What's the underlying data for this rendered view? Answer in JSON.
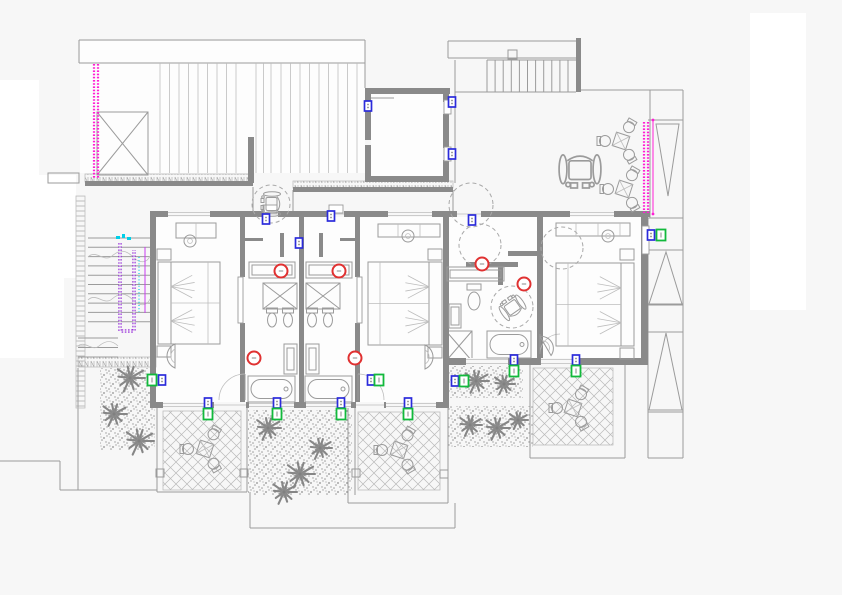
{
  "meta": {
    "type": "architectural-floor-plan-cad-drawing",
    "visible_text": "none"
  },
  "colors": {
    "background": "#f7f7f7",
    "paper_white": "#ffffff",
    "wall": "#8a8a8a",
    "line": "#9b9b9b",
    "light_line": "#bdbdbd",
    "magenta": "#ff1fd4",
    "purple": "#8b16d6",
    "cyan": "#00cfe8",
    "red_marker": "#e03131",
    "blue_marker": "#2b2bdb",
    "green_marker": "#12b93c"
  },
  "white_patches": [
    [
      0,
      80,
      39,
      278
    ],
    [
      0,
      175,
      76,
      103
    ],
    [
      0,
      278,
      64,
      80
    ],
    [
      750,
      13,
      56,
      297
    ]
  ],
  "room_fills": [
    [
      80,
      41,
      285,
      132
    ],
    [
      371,
      94,
      72,
      82
    ],
    [
      156,
      217,
      287,
      185
    ],
    [
      449,
      217,
      192,
      141
    ]
  ],
  "walls": [
    [
      150,
      211,
      500,
      6
    ],
    [
      150,
      211,
      6,
      197
    ],
    [
      150,
      402,
      298,
      6
    ],
    [
      443,
      358,
      205,
      7
    ],
    [
      641,
      211,
      7,
      154
    ],
    [
      443,
      211,
      6,
      154
    ],
    [
      443,
      358,
      6,
      50
    ],
    [
      537,
      217,
      6,
      148
    ],
    [
      240,
      217,
      5,
      60
    ],
    [
      240,
      323,
      5,
      84
    ],
    [
      355,
      217,
      5,
      60
    ],
    [
      355,
      323,
      5,
      84
    ],
    [
      299,
      217,
      5,
      186
    ],
    [
      280,
      233,
      4,
      24
    ],
    [
      319,
      233,
      4,
      24
    ],
    [
      245,
      238,
      18,
      3
    ],
    [
      340,
      238,
      18,
      3
    ],
    [
      466,
      262,
      52,
      5
    ],
    [
      498,
      267,
      5,
      18
    ],
    [
      508,
      251,
      29,
      5
    ],
    [
      365,
      88,
      85,
      6
    ],
    [
      365,
      88,
      6,
      52
    ],
    [
      365,
      145,
      6,
      37
    ],
    [
      443,
      88,
      6,
      14
    ],
    [
      443,
      114,
      6,
      34
    ],
    [
      443,
      160,
      6,
      22
    ],
    [
      365,
      176,
      84,
      6
    ],
    [
      85,
      181,
      168,
      5
    ],
    [
      293,
      187,
      160,
      5
    ],
    [
      248,
      137,
      6,
      46
    ],
    [
      576,
      38,
      5,
      54
    ]
  ],
  "windows": [
    [
      168,
      211,
      42,
      6
    ],
    [
      388,
      211,
      44,
      6
    ],
    [
      570,
      211,
      44,
      6
    ],
    [
      163,
      402,
      46,
      6
    ],
    [
      249,
      402,
      45,
      6
    ],
    [
      306,
      402,
      45,
      6
    ],
    [
      386,
      402,
      50,
      6
    ],
    [
      466,
      358,
      42,
      7
    ],
    [
      541,
      358,
      36,
      7
    ]
  ],
  "door_gaps": [
    [
      214,
      402,
      32,
      6
    ],
    [
      356,
      402,
      28,
      6
    ],
    [
      457,
      211,
      24,
      6
    ],
    [
      263,
      211,
      15,
      6
    ],
    [
      329,
      211,
      15,
      6
    ]
  ],
  "door_leafs": [
    [
      263,
      205,
      14,
      8
    ],
    [
      329,
      205,
      14,
      8
    ],
    [
      238,
      277,
      5,
      46
    ],
    [
      357,
      277,
      5,
      46
    ],
    [
      444,
      100,
      7,
      14
    ],
    [
      444,
      147,
      7,
      14
    ],
    [
      642,
      226,
      7,
      28
    ]
  ],
  "thin_lines": [
    [
      79,
      40,
      365,
      40
    ],
    [
      79,
      40,
      79,
      63
    ],
    [
      79,
      63,
      365,
      63
    ],
    [
      365,
      40,
      365,
      88
    ],
    [
      369,
      98,
      394,
      98
    ],
    [
      448,
      41,
      576,
      41
    ],
    [
      448,
      41,
      448,
      58
    ],
    [
      448,
      58,
      576,
      58
    ],
    [
      487,
      60,
      576,
      60
    ],
    [
      455,
      92,
      576,
      92
    ],
    [
      455,
      60,
      455,
      92
    ],
    [
      455,
      92,
      455,
      183
    ],
    [
      650,
      90,
      650,
      218
    ],
    [
      580,
      90,
      683,
      90
    ],
    [
      683,
      90,
      683,
      458
    ],
    [
      648,
      218,
      648,
      458
    ],
    [
      648,
      120,
      683,
      120
    ],
    [
      648,
      218,
      683,
      218
    ],
    [
      648,
      250,
      683,
      250
    ],
    [
      648,
      305,
      683,
      305
    ],
    [
      648,
      332,
      683,
      332
    ],
    [
      648,
      412,
      683,
      412
    ],
    [
      648,
      458,
      683,
      458
    ],
    [
      253,
      187,
      253,
      211
    ],
    [
      293,
      190,
      293,
      211
    ],
    [
      453,
      190,
      453,
      211
    ],
    [
      0,
      461,
      60,
      461
    ],
    [
      60,
      461,
      60,
      490
    ],
    [
      60,
      490,
      157,
      490
    ],
    [
      78,
      368,
      78,
      490
    ],
    [
      157,
      408,
      157,
      492
    ],
    [
      247,
      408,
      247,
      492
    ],
    [
      157,
      492,
      247,
      492
    ],
    [
      250,
      492,
      250,
      528
    ],
    [
      250,
      528,
      455,
      528
    ],
    [
      455,
      503,
      455,
      528
    ],
    [
      348,
      408,
      348,
      503
    ],
    [
      448,
      408,
      448,
      503
    ],
    [
      348,
      503,
      448,
      503
    ],
    [
      355,
      408,
      355,
      495
    ],
    [
      530,
      365,
      530,
      458
    ],
    [
      625,
      365,
      625,
      458
    ],
    [
      530,
      458,
      625,
      458
    ]
  ],
  "thin_rects": [
    [
      48,
      173,
      31,
      10
    ],
    [
      508,
      50,
      9,
      9
    ],
    [
      249,
      262,
      46,
      16
    ],
    [
      252,
      265,
      40,
      10
    ],
    [
      306,
      262,
      46,
      16
    ],
    [
      309,
      265,
      40,
      10
    ],
    [
      447,
      267,
      57,
      14
    ],
    [
      450,
      270,
      51,
      8
    ],
    [
      284,
      344,
      13,
      30
    ],
    [
      287,
      348,
      7,
      22
    ],
    [
      306,
      344,
      13,
      30
    ],
    [
      309,
      348,
      7,
      22
    ],
    [
      449,
      304,
      12,
      24
    ],
    [
      451,
      307,
      8,
      18
    ],
    [
      156,
      469,
      8,
      8
    ],
    [
      240,
      469,
      8,
      8
    ],
    [
      352,
      469,
      8,
      8
    ],
    [
      440,
      470,
      8,
      8
    ]
  ],
  "x_boxes": [
    [
      97,
      112,
      51,
      63
    ],
    [
      263,
      283,
      34,
      26
    ],
    [
      306,
      283,
      34,
      26
    ],
    [
      446,
      331,
      26,
      30
    ]
  ],
  "hatch_bands": [
    [
      85,
      174,
      168,
      8
    ],
    [
      293,
      181,
      160,
      7
    ],
    [
      78,
      357,
      78,
      10
    ]
  ],
  "ladder_strip": [
    76,
    196,
    9,
    212
  ],
  "rafter_groups": [
    {
      "x1": 160,
      "x2": 243,
      "step": 9.5,
      "y1": 63,
      "y2": 173
    },
    {
      "x1": 256,
      "x2": 278,
      "step": 7.5,
      "y1": 63,
      "y2": 173
    },
    {
      "x1": 281,
      "x2": 357,
      "step": 9.5,
      "y1": 63,
      "y2": 173
    }
  ],
  "top_stair_treads": {
    "x1": 487,
    "x2": 576,
    "step": 8.1,
    "y1": 60,
    "y2": 92
  },
  "left_stair": {
    "treads": {
      "y1": 238,
      "y2": 331,
      "step": 9.3,
      "x1": 88,
      "x2": 150
    },
    "treads2": {
      "y1": 338,
      "y2": 357,
      "step": 9.5,
      "x1": 78,
      "x2": 118
    },
    "waves": [
      "M88,257 C96,249 104,263 112,256 S126,250 133,257 S147,263 150,256",
      "M88,300 C96,292 104,306 112,299 S126,293 133,300 S147,306 150,299",
      "M78,346 C85,340 92,352 99,346 S112,340 118,346"
    ],
    "rail_path": "M120,243 L120,331 L134,331 L134,250",
    "rail_thin": [
      145,
      247,
      145,
      313
    ],
    "cyan_dotted": [
      139,
      257,
      139,
      312
    ],
    "top_marks": [
      [
        116,
        236,
        4,
        3
      ],
      [
        122,
        234,
        3,
        4
      ],
      [
        127,
        237,
        4,
        3
      ]
    ]
  },
  "diamond_terraces": [
    [
      163,
      411,
      78,
      79
    ],
    [
      358,
      412,
      82,
      78
    ],
    [
      533,
      368,
      80,
      77
    ]
  ],
  "stipple_beds": [
    [
      100,
      368,
      55,
      82
    ],
    [
      248,
      410,
      104,
      85
    ],
    [
      448,
      366,
      75,
      32
    ],
    [
      448,
      406,
      85,
      41
    ]
  ],
  "palms": [
    [
      130,
      378,
      15
    ],
    [
      114,
      414,
      13
    ],
    [
      139,
      441,
      15
    ],
    [
      268,
      428,
      13
    ],
    [
      300,
      474,
      15
    ],
    [
      320,
      448,
      12
    ],
    [
      284,
      492,
      13
    ],
    [
      476,
      381,
      13
    ],
    [
      504,
      384,
      11
    ],
    [
      470,
      425,
      12
    ],
    [
      497,
      428,
      13
    ],
    [
      518,
      420,
      10
    ]
  ],
  "tables": [
    [
      205,
      449,
      17
    ],
    [
      399,
      450,
      17
    ],
    [
      573,
      408,
      16
    ],
    [
      621,
      141,
      16
    ],
    [
      624,
      189,
      16
    ]
  ],
  "beds": [
    {
      "x": 158,
      "y": 262,
      "w": 62,
      "h": 82,
      "head": "left"
    },
    {
      "x": 368,
      "y": 262,
      "w": 74,
      "h": 83,
      "head": "right"
    },
    {
      "x": 556,
      "y": 263,
      "w": 78,
      "h": 83,
      "head": "right"
    }
  ],
  "nightstands": [
    [
      157,
      249,
      14,
      11
    ],
    [
      157,
      346,
      14,
      11
    ],
    [
      428,
      249,
      14,
      11
    ],
    [
      428,
      347,
      14,
      11
    ],
    [
      620,
      249,
      14,
      11
    ],
    [
      620,
      348,
      14,
      11
    ]
  ],
  "desks": [
    {
      "x": 176,
      "y": 223,
      "w": 40,
      "h": 15,
      "chair": [
        190,
        241
      ]
    },
    {
      "x": 378,
      "y": 224,
      "w": 62,
      "h": 13,
      "chair": [
        408,
        236
      ]
    },
    {
      "x": 556,
      "y": 223,
      "w": 74,
      "h": 13,
      "chair": [
        608,
        236
      ]
    }
  ],
  "armchairs": [
    {
      "cx": 171,
      "cy": 356,
      "r": 13,
      "rot": 0
    },
    {
      "cx": 429,
      "cy": 357,
      "r": 13,
      "rot": 180
    },
    {
      "cx": 549,
      "cy": 344,
      "r": 12,
      "rot": 150
    }
  ],
  "door_arcs": [
    {
      "d": "M219,400 A26,26 0 0 1 245,374",
      "leaf": [
        245,
        400,
        245,
        374
      ]
    },
    {
      "d": "M384,400 A26,26 0 0 0 358,374",
      "leaf": [
        358,
        400,
        358,
        374
      ]
    },
    {
      "d": "M540,354 A20,20 0 0 1 560,334",
      "leaf": [
        540,
        334,
        540,
        354
      ]
    }
  ],
  "bathtubs": [
    [
      248,
      376,
      47,
      26
    ],
    [
      305,
      376,
      47,
      26
    ],
    [
      487,
      331,
      44,
      27
    ]
  ],
  "toilets_small": [
    [
      272,
      316
    ],
    [
      288,
      316
    ],
    [
      312,
      316
    ],
    [
      328,
      316
    ]
  ],
  "toilet_large": {
    "tank": [
      467,
      284,
      14,
      6
    ],
    "bowl": [
      474,
      301,
      6,
      9
    ]
  },
  "red_lights": [
    [
      281,
      271
    ],
    [
      339,
      271
    ],
    [
      254,
      358
    ],
    [
      355,
      358
    ],
    [
      482,
      264
    ],
    [
      524,
      284
    ]
  ],
  "blue_sockets": [
    [
      368,
      106
    ],
    [
      452,
      102
    ],
    [
      452,
      154
    ],
    [
      266,
      219
    ],
    [
      331,
      216
    ],
    [
      299,
      243
    ],
    [
      472,
      220
    ],
    [
      162,
      380
    ],
    [
      371,
      380
    ],
    [
      455,
      381
    ],
    [
      208,
      403
    ],
    [
      277,
      403
    ],
    [
      341,
      403
    ],
    [
      408,
      403
    ],
    [
      514,
      360
    ],
    [
      576,
      360
    ],
    [
      651,
      235
    ]
  ],
  "green_sockets": [
    [
      152,
      380
    ],
    [
      379,
      380
    ],
    [
      464,
      381
    ],
    [
      208,
      414
    ],
    [
      277,
      414
    ],
    [
      341,
      414
    ],
    [
      408,
      414
    ],
    [
      514,
      371
    ],
    [
      576,
      371
    ],
    [
      661,
      235
    ]
  ],
  "dashed_circles": [
    [
      271,
      204,
      19
    ],
    [
      471,
      205,
      22
    ],
    [
      480,
      245,
      21
    ],
    [
      562,
      248,
      21
    ],
    [
      512,
      307,
      21
    ]
  ],
  "wheelchairs": [
    {
      "cx": 271,
      "cy": 204,
      "s": 1.0,
      "rot": -90
    },
    {
      "cx": 512,
      "cy": 307,
      "s": 1.0,
      "rot": -35
    },
    {
      "cx": 580,
      "cy": 171,
      "s": 1.7,
      "rot": 180
    }
  ],
  "triangles": [
    [
      656,
      124,
      679,
      124,
      668,
      196
    ],
    [
      666,
      252,
      649,
      304,
      682,
      304
    ],
    [
      666,
      333,
      649,
      410,
      682,
      410
    ]
  ],
  "magenta_dotted": [
    [
      94,
      64,
      178
    ],
    [
      98,
      64,
      178
    ],
    [
      644,
      122,
      213
    ],
    [
      648,
      122,
      213
    ]
  ],
  "magenta_solid": [
    [
      653,
      120,
      653,
      214
    ]
  ]
}
